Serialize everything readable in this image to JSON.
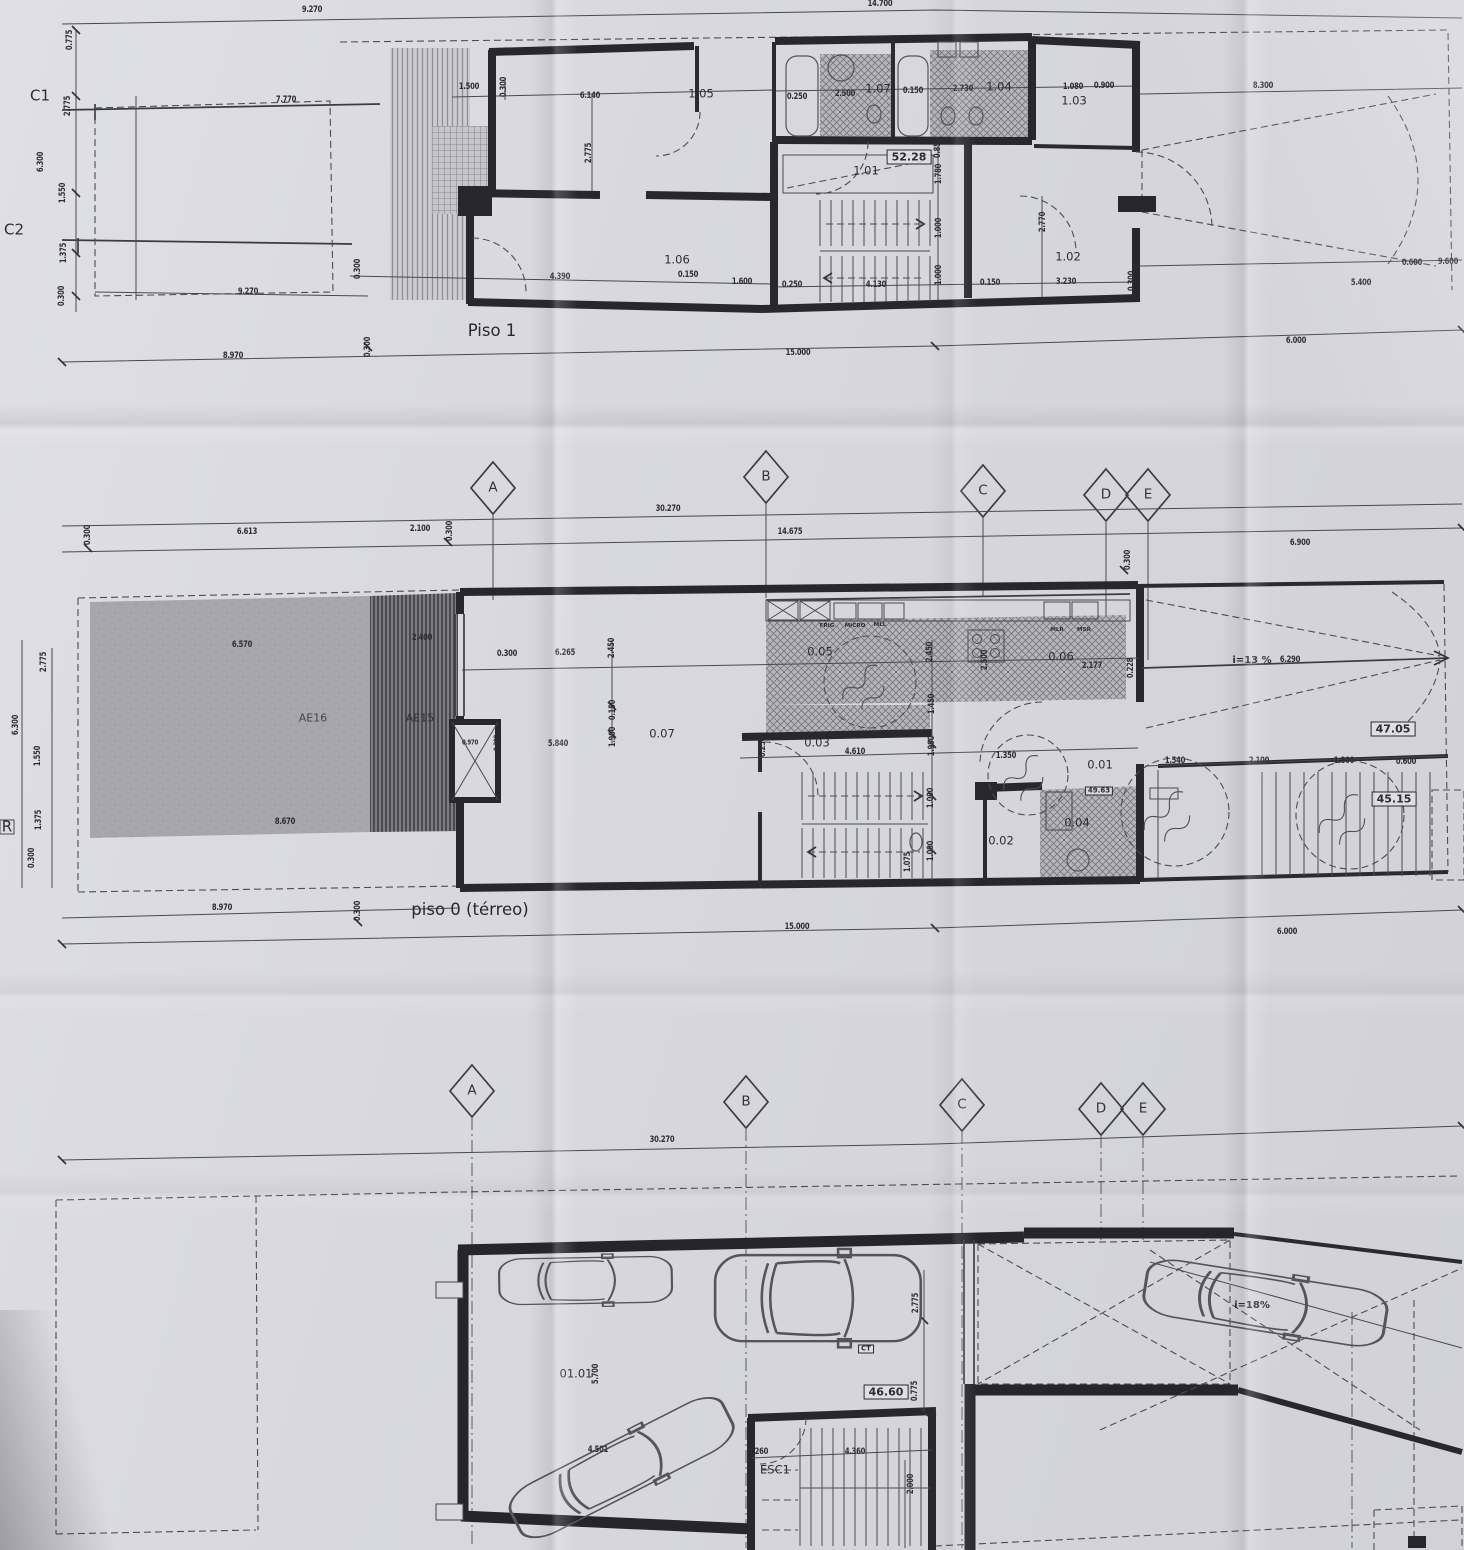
{
  "sheet": {
    "floor_titles": [
      "Piso 1",
      "piso 0 (térreo)"
    ],
    "grid_axes": [
      "A",
      "B",
      "C",
      "D",
      "E"
    ],
    "section_marks": [
      "C1",
      "C2",
      "R"
    ],
    "area_badges": [
      "52.28",
      "47.05",
      "45.15",
      "49.63",
      "46.60"
    ],
    "ink_color": "#28272d",
    "paper_color": "#d9d8e0"
  },
  "labels": {
    "piso1": [
      {
        "k": "dim",
        "t": "9.270",
        "x": 312,
        "y": 10
      },
      {
        "k": "dim",
        "t": "14.700",
        "x": 880,
        "y": 4
      },
      {
        "k": "dim",
        "t": "8.300",
        "x": 1263,
        "y": 86
      },
      {
        "k": "mark",
        "t": "C1",
        "x": 40,
        "y": 96
      },
      {
        "k": "mark",
        "t": "C2",
        "x": 14,
        "y": 230
      },
      {
        "k": "dim",
        "t": "0.775",
        "x": 70,
        "y": 40,
        "r": -90
      },
      {
        "k": "dim",
        "t": "2.775",
        "x": 68,
        "y": 106,
        "r": -90
      },
      {
        "k": "dim",
        "t": "6.300",
        "x": 41,
        "y": 162,
        "r": -90
      },
      {
        "k": "dim",
        "t": "1.550",
        "x": 63,
        "y": 193,
        "r": -90
      },
      {
        "k": "dim",
        "t": "1.375",
        "x": 64,
        "y": 253,
        "r": -90
      },
      {
        "k": "dim",
        "t": "0.300",
        "x": 62,
        "y": 296,
        "r": -90
      },
      {
        "k": "dim",
        "t": "7.770",
        "x": 286,
        "y": 100
      },
      {
        "k": "dim",
        "t": "1.500",
        "x": 469,
        "y": 87
      },
      {
        "k": "dim",
        "t": "0.300",
        "x": 504,
        "y": 87,
        "r": -90
      },
      {
        "k": "dim",
        "t": "6.140",
        "x": 590,
        "y": 96
      },
      {
        "k": "dim",
        "t": "2.775",
        "x": 589,
        "y": 153,
        "r": -90
      },
      {
        "k": "room",
        "t": "1.05",
        "x": 701,
        "y": 94
      },
      {
        "k": "dim",
        "t": "0.250",
        "x": 797,
        "y": 97
      },
      {
        "k": "dim",
        "t": "2.500",
        "x": 845,
        "y": 94
      },
      {
        "k": "room",
        "t": "1.07",
        "x": 878,
        "y": 89
      },
      {
        "k": "dim",
        "t": "0.150",
        "x": 913,
        "y": 91
      },
      {
        "k": "dim",
        "t": "2.730",
        "x": 963,
        "y": 89
      },
      {
        "k": "room",
        "t": "1.04",
        "x": 999,
        "y": 87
      },
      {
        "k": "dim",
        "t": "1.080",
        "x": 1073,
        "y": 87
      },
      {
        "k": "dim",
        "t": "0.900",
        "x": 1104,
        "y": 86
      },
      {
        "k": "room",
        "t": "1.03",
        "x": 1074,
        "y": 101
      },
      {
        "k": "badge",
        "t": "52.28",
        "x": 909,
        "y": 157
      },
      {
        "k": "room",
        "t": "1.01",
        "x": 866,
        "y": 171
      },
      {
        "k": "dim",
        "t": "0.850",
        "x": 938,
        "y": 148,
        "r": -90
      },
      {
        "k": "dim",
        "t": "1.780",
        "x": 939,
        "y": 174,
        "r": -90
      },
      {
        "k": "dim",
        "t": "1.000",
        "x": 939,
        "y": 228,
        "r": -90
      },
      {
        "k": "dim",
        "t": "1.000",
        "x": 939,
        "y": 275,
        "r": -90
      },
      {
        "k": "dim",
        "t": "2.770",
        "x": 1043,
        "y": 222,
        "r": -90
      },
      {
        "k": "room",
        "t": "1.02",
        "x": 1068,
        "y": 257
      },
      {
        "k": "room",
        "t": "1.06",
        "x": 677,
        "y": 260
      },
      {
        "k": "dim",
        "t": "0.300",
        "x": 358,
        "y": 269,
        "r": -90
      },
      {
        "k": "dim",
        "t": "4.390",
        "x": 560,
        "y": 277
      },
      {
        "k": "dim",
        "t": "0.150",
        "x": 688,
        "y": 275
      },
      {
        "k": "dim",
        "t": "1.600",
        "x": 742,
        "y": 282
      },
      {
        "k": "dim",
        "t": "0.250",
        "x": 792,
        "y": 285
      },
      {
        "k": "dim",
        "t": "4.130",
        "x": 876,
        "y": 285
      },
      {
        "k": "dim",
        "t": "0.150",
        "x": 990,
        "y": 283
      },
      {
        "k": "dim",
        "t": "3.230",
        "x": 1066,
        "y": 282
      },
      {
        "k": "dim",
        "t": "0.300",
        "x": 1132,
        "y": 281,
        "r": -90
      },
      {
        "k": "dim",
        "t": "5.400",
        "x": 1361,
        "y": 283
      },
      {
        "k": "dim",
        "t": "0.600",
        "x": 1412,
        "y": 263
      },
      {
        "k": "dim",
        "t": "9.600",
        "x": 1448,
        "y": 262
      },
      {
        "k": "title",
        "t": "Piso 1",
        "x": 492,
        "y": 331
      },
      {
        "k": "dim",
        "t": "9.270",
        "x": 248,
        "y": 292
      },
      {
        "k": "dim",
        "t": "8.970",
        "x": 233,
        "y": 356
      },
      {
        "k": "dim",
        "t": "0.300",
        "x": 368,
        "y": 347,
        "r": -90
      },
      {
        "k": "dim",
        "t": "15.000",
        "x": 798,
        "y": 353
      },
      {
        "k": "dim",
        "t": "6.000",
        "x": 1296,
        "y": 341
      }
    ],
    "grid_top": [
      {
        "k": "axis",
        "t": "A",
        "x": 493,
        "y": 488
      },
      {
        "k": "axis",
        "t": "B",
        "x": 766,
        "y": 477
      },
      {
        "k": "axis",
        "t": "C",
        "x": 983,
        "y": 491
      },
      {
        "k": "axis",
        "t": "D",
        "x": 1106,
        "y": 495
      },
      {
        "k": "axis",
        "t": "E",
        "x": 1148,
        "y": 495
      },
      {
        "k": "dim",
        "t": "30.270",
        "x": 668,
        "y": 509
      },
      {
        "k": "dim",
        "t": "14.675",
        "x": 790,
        "y": 532
      },
      {
        "k": "dim",
        "t": "0.300",
        "x": 88,
        "y": 535,
        "r": -90
      },
      {
        "k": "dim",
        "t": "6.613",
        "x": 247,
        "y": 532
      },
      {
        "k": "dim",
        "t": "2.100",
        "x": 420,
        "y": 529
      },
      {
        "k": "dim",
        "t": "0.300",
        "x": 450,
        "y": 531,
        "r": -90
      },
      {
        "k": "dim",
        "t": "0.300",
        "x": 1128,
        "y": 560,
        "r": -90
      },
      {
        "k": "dim",
        "t": "6.900",
        "x": 1300,
        "y": 543
      }
    ],
    "piso0": [
      {
        "k": "dim",
        "t": "2.775",
        "x": 44,
        "y": 662,
        "r": -90
      },
      {
        "k": "dim",
        "t": "6.300",
        "x": 16,
        "y": 725,
        "r": -90
      },
      {
        "k": "dim",
        "t": "1.550",
        "x": 38,
        "y": 756,
        "r": -90
      },
      {
        "k": "dim",
        "t": "1.375",
        "x": 39,
        "y": 820,
        "r": -90
      },
      {
        "k": "dim",
        "t": "0.300",
        "x": 32,
        "y": 858,
        "r": -90
      },
      {
        "k": "mark",
        "t": "R",
        "x": 7,
        "y": 827,
        "n": "section-mark"
      },
      {
        "k": "dim",
        "t": "6.570",
        "x": 242,
        "y": 645
      },
      {
        "k": "dim",
        "t": "2.400",
        "x": 422,
        "y": 638
      },
      {
        "k": "zone",
        "t": "AE16",
        "x": 313,
        "y": 718
      },
      {
        "k": "zoneD",
        "t": "AE15",
        "x": 420,
        "y": 718
      },
      {
        "k": "dim",
        "t": "8.670",
        "x": 285,
        "y": 822
      },
      {
        "k": "small",
        "t": "0.970",
        "x": 470,
        "y": 743
      },
      {
        "k": "small",
        "t": "0.300",
        "x": 497,
        "y": 743,
        "r": -90
      },
      {
        "k": "dim",
        "t": "0.300",
        "x": 507,
        "y": 654
      },
      {
        "k": "dim",
        "t": "6.265",
        "x": 565,
        "y": 653
      },
      {
        "k": "dim",
        "t": "2.450",
        "x": 612,
        "y": 648,
        "r": -90
      },
      {
        "k": "dim",
        "t": "0.150",
        "x": 613,
        "y": 710,
        "r": -90
      },
      {
        "k": "dim",
        "t": "1.900",
        "x": 613,
        "y": 737,
        "r": -90
      },
      {
        "k": "dim",
        "t": "5.840",
        "x": 558,
        "y": 744
      },
      {
        "k": "room",
        "t": "0.07",
        "x": 662,
        "y": 734
      },
      {
        "k": "dim",
        "t": "0.250",
        "x": 763,
        "y": 747,
        "r": -90
      },
      {
        "k": "room",
        "t": "0.05",
        "x": 820,
        "y": 652
      },
      {
        "k": "appl",
        "t": "FRIG",
        "x": 827,
        "y": 627
      },
      {
        "k": "appl",
        "t": "MICRO",
        "x": 855,
        "y": 627
      },
      {
        "k": "appl",
        "t": "MLL",
        "x": 880,
        "y": 626
      },
      {
        "k": "dim",
        "t": "2.450",
        "x": 930,
        "y": 652,
        "r": -90
      },
      {
        "k": "dim",
        "t": "2.500",
        "x": 985,
        "y": 660,
        "r": -90
      },
      {
        "k": "room",
        "t": "0.06",
        "x": 1061,
        "y": 657
      },
      {
        "k": "appl",
        "t": "MLR",
        "x": 1057,
        "y": 631
      },
      {
        "k": "appl",
        "t": "MSR",
        "x": 1084,
        "y": 631
      },
      {
        "k": "dim",
        "t": "2.177",
        "x": 1092,
        "y": 666
      },
      {
        "k": "dim",
        "t": "0.228",
        "x": 1131,
        "y": 668,
        "r": -90
      },
      {
        "k": "slope",
        "t": "i=13 %",
        "x": 1252,
        "y": 661
      },
      {
        "k": "dim",
        "t": "6.290",
        "x": 1290,
        "y": 660
      },
      {
        "k": "dim",
        "t": "1.450",
        "x": 932,
        "y": 704,
        "r": -90
      },
      {
        "k": "room",
        "t": "0.03",
        "x": 817,
        "y": 743
      },
      {
        "k": "dim",
        "t": "4.610",
        "x": 855,
        "y": 752
      },
      {
        "k": "dim",
        "t": "1.900",
        "x": 932,
        "y": 746,
        "r": -90
      },
      {
        "k": "dim",
        "t": "1.000",
        "x": 931,
        "y": 798,
        "r": -90
      },
      {
        "k": "dim",
        "t": "1.000",
        "x": 931,
        "y": 851,
        "r": -90
      },
      {
        "k": "room",
        "t": "0.02",
        "x": 1001,
        "y": 841
      },
      {
        "k": "dim",
        "t": "1.350",
        "x": 1006,
        "y": 756
      },
      {
        "k": "room",
        "t": "0.01",
        "x": 1100,
        "y": 765
      },
      {
        "k": "bsm",
        "t": "49.63",
        "x": 1099,
        "y": 791
      },
      {
        "k": "room",
        "t": "0.04",
        "x": 1077,
        "y": 823
      },
      {
        "k": "dim",
        "t": "1.075",
        "x": 908,
        "y": 862,
        "r": -90
      },
      {
        "k": "badge",
        "t": "47.05",
        "x": 1393,
        "y": 729
      },
      {
        "k": "dim",
        "t": "1.540",
        "x": 1175,
        "y": 761
      },
      {
        "k": "dim",
        "t": "2.100",
        "x": 1259,
        "y": 761
      },
      {
        "k": "dim",
        "t": "1.800",
        "x": 1344,
        "y": 761
      },
      {
        "k": "dim",
        "t": "0.600",
        "x": 1406,
        "y": 762
      },
      {
        "k": "badge",
        "t": "45.15",
        "x": 1394,
        "y": 799
      },
      {
        "k": "dim",
        "t": "8.970",
        "x": 222,
        "y": 908
      },
      {
        "k": "dim",
        "t": "0.300",
        "x": 358,
        "y": 911,
        "r": -90
      },
      {
        "k": "title",
        "t": "piso 0 (térreo)",
        "x": 470,
        "y": 910
      },
      {
        "k": "dim",
        "t": "15.000",
        "x": 797,
        "y": 927
      },
      {
        "k": "dim",
        "t": "6.000",
        "x": 1287,
        "y": 932
      }
    ],
    "grid_bottom": [
      {
        "k": "axis",
        "t": "A",
        "x": 472,
        "y": 1091
      },
      {
        "k": "axis",
        "t": "B",
        "x": 746,
        "y": 1102
      },
      {
        "k": "axis",
        "t": "C",
        "x": 962,
        "y": 1105
      },
      {
        "k": "axis",
        "t": "D",
        "x": 1101,
        "y": 1109
      },
      {
        "k": "axis",
        "t": "E",
        "x": 1143,
        "y": 1109
      },
      {
        "k": "dim",
        "t": "30.270",
        "x": 662,
        "y": 1140
      }
    ],
    "garagem": [
      {
        "k": "room",
        "t": "01.01",
        "x": 576,
        "y": 1374
      },
      {
        "k": "dim",
        "t": "5.700",
        "x": 596,
        "y": 1374,
        "r": -90
      },
      {
        "k": "dim",
        "t": "4.501",
        "x": 598,
        "y": 1450
      },
      {
        "k": "dim",
        "t": "0.260",
        "x": 758,
        "y": 1452
      },
      {
        "k": "dim",
        "t": "4.360",
        "x": 855,
        "y": 1452
      },
      {
        "k": "dim",
        "t": "2.000",
        "x": 911,
        "y": 1484,
        "r": -90
      },
      {
        "k": "room",
        "t": "ESC1",
        "x": 775,
        "y": 1470
      },
      {
        "k": "badge",
        "t": "46.60",
        "x": 886,
        "y": 1392
      },
      {
        "k": "bsm",
        "t": "CT",
        "x": 866,
        "y": 1349
      },
      {
        "k": "dim",
        "t": "2.775",
        "x": 916,
        "y": 1303,
        "r": -90
      },
      {
        "k": "dim",
        "t": "0.775",
        "x": 915,
        "y": 1391,
        "r": -90
      },
      {
        "k": "slope",
        "t": "i=18%",
        "x": 1252,
        "y": 1306
      }
    ]
  }
}
